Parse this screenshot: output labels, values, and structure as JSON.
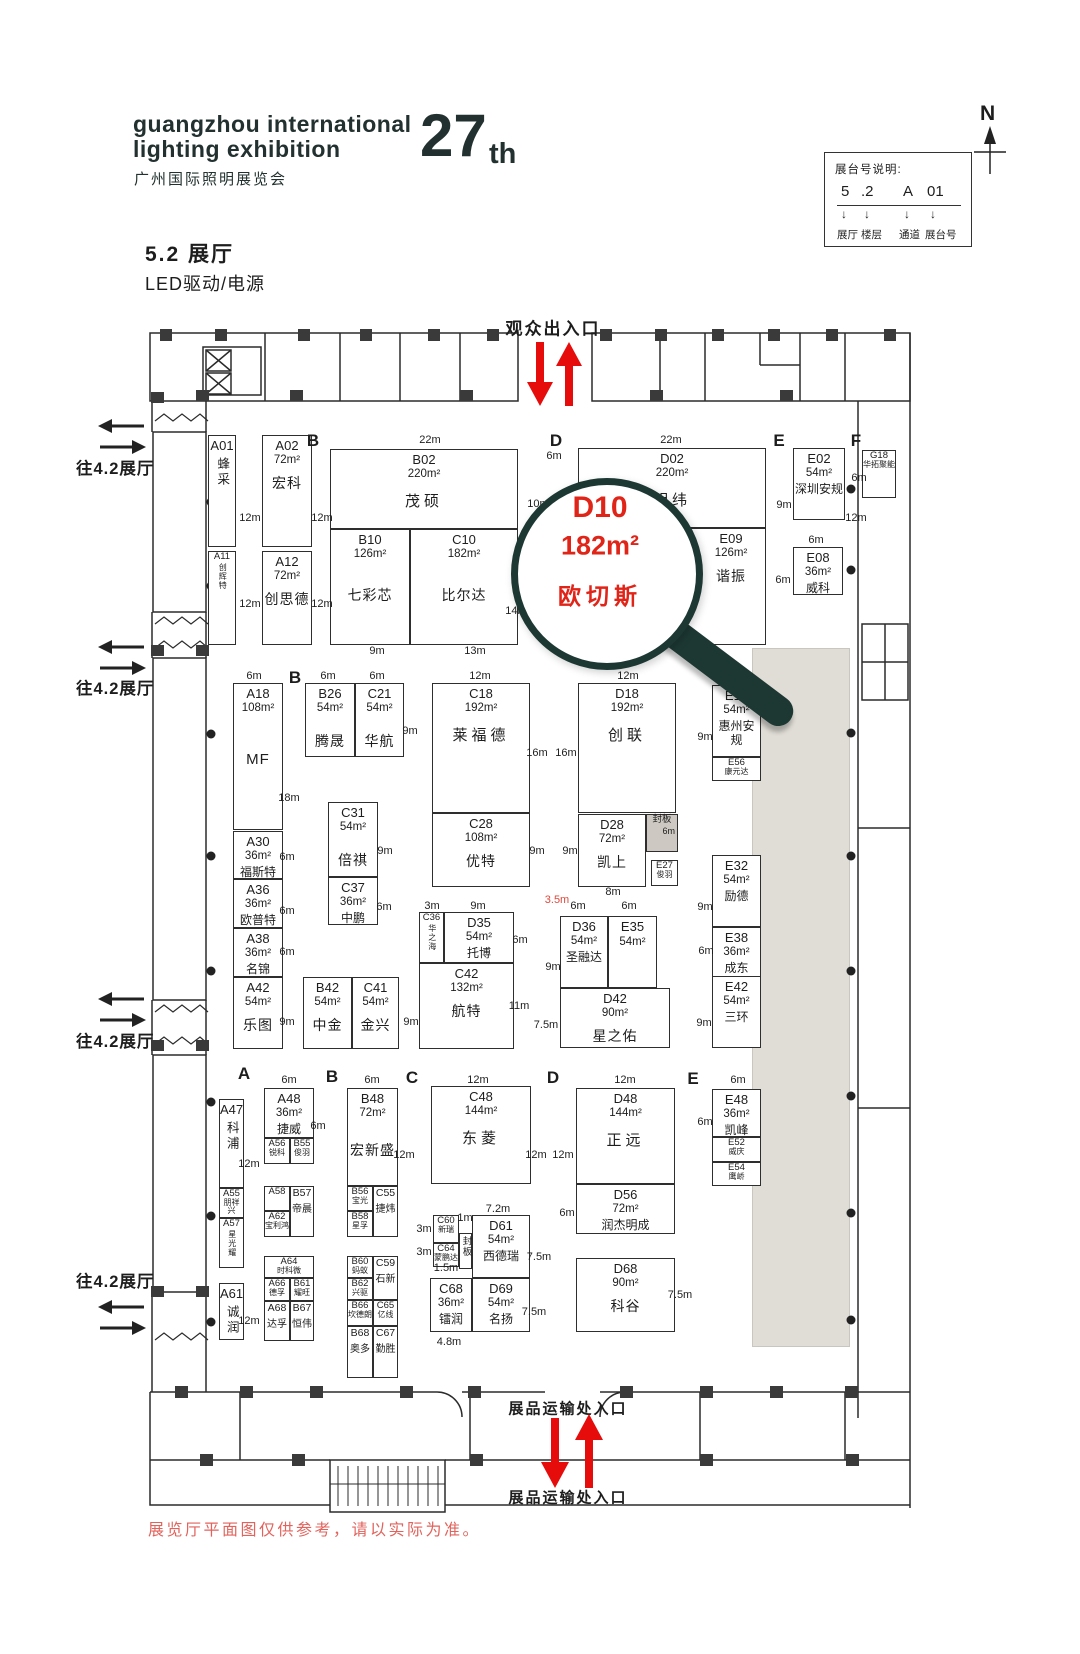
{
  "header": {
    "logo_line1": "guangzhou international",
    "logo_line2": "lighting exhibition",
    "logo_cn": "广州国际照明展览会",
    "edition_number": "27",
    "edition_suffix": "th",
    "hall_title": "5.2 展厅",
    "hall_subtitle": "LED驱动/电源",
    "compass_n": "N"
  },
  "legend": {
    "title": "展台号说明:",
    "code_parts": [
      "5",
      ".2",
      "A",
      "01"
    ],
    "arrow": "↓",
    "labels": [
      "展厅",
      "楼层",
      "通道",
      "展台号"
    ]
  },
  "entrances": {
    "visitor": "观众出入口",
    "freight_top": "展品运输处入口",
    "freight_bottom": "展品运输处入口"
  },
  "side_labels": [
    "往4.2展厅",
    "往4.2展厅",
    "往4.2展厅",
    "往4.2展厅"
  ],
  "letters": [
    "B",
    "D",
    "E",
    "F",
    "B",
    "A",
    "B",
    "C",
    "D",
    "E"
  ],
  "magnifier": {
    "booth_id": "D10",
    "area": "182m²",
    "name": "欧切斯"
  },
  "booths": {
    "A01": {
      "id": "A01",
      "name": "蜂采"
    },
    "A11": {
      "id": "A11",
      "name": "创辉特"
    },
    "A02": {
      "id": "A02",
      "area": "72m²",
      "name": "宏科"
    },
    "A12": {
      "id": "A12",
      "area": "72m²",
      "name": "创思德"
    },
    "B02": {
      "id": "B02",
      "area": "220m²",
      "name": "茂硕"
    },
    "B10": {
      "id": "B10",
      "area": "126m²",
      "name": "七彩芯"
    },
    "C10": {
      "id": "C10",
      "area": "182m²",
      "name": "比尔达"
    },
    "D02": {
      "id": "D02",
      "area": "220m²",
      "name": "明纬"
    },
    "D10": {
      "id": "D10"
    },
    "E09": {
      "id": "E09",
      "area": "126m²",
      "name": "谐振"
    },
    "E02": {
      "id": "E02",
      "area": "54m²",
      "name": "深圳安规"
    },
    "G18": {
      "id": "G18",
      "name": "华拓聚能"
    },
    "E08": {
      "id": "E08",
      "area": "36m²",
      "name": "威科"
    },
    "A18": {
      "id": "A18",
      "area": "108m²",
      "name": "MF"
    },
    "B26": {
      "id": "B26",
      "area": "54m²",
      "name": "腾晟"
    },
    "C21": {
      "id": "C21",
      "area": "54m²",
      "name": "华航"
    },
    "C18": {
      "id": "C18",
      "area": "192m²",
      "name": "莱福德"
    },
    "D18": {
      "id": "D18",
      "area": "192m²",
      "name": "创联"
    },
    "E18": {
      "id": "E18",
      "area": "54m²",
      "name": "惠州安规"
    },
    "E56": {
      "id": "E56",
      "name": "康元达"
    },
    "A30": {
      "id": "A30",
      "area": "36m²",
      "name": "福斯特"
    },
    "C31": {
      "id": "C31",
      "area": "54m²",
      "name": "倍祺"
    },
    "C37": {
      "id": "C37",
      "area": "36m²",
      "name": "中鹏"
    },
    "A36": {
      "id": "A36",
      "area": "36m²",
      "name": "欧普特"
    },
    "A38": {
      "id": "A38",
      "area": "36m²",
      "name": "名锦"
    },
    "C28": {
      "id": "C28",
      "area": "108m²",
      "name": "优特"
    },
    "D28": {
      "id": "D28",
      "area": "72m²",
      "name": "凯上"
    },
    "FB1": {
      "id": "封板",
      "area": "6m"
    },
    "E27": {
      "id": "E27",
      "name": "俊羽"
    },
    "E32": {
      "id": "E32",
      "area": "54m²",
      "name": "励德"
    },
    "E38": {
      "id": "E38",
      "area": "36m²",
      "name": "成东"
    },
    "C36": {
      "id": "C36",
      "name": "华之海"
    },
    "D35": {
      "id": "D35",
      "area": "54m²",
      "name": "托博"
    },
    "C42": {
      "id": "C42",
      "area": "132m²",
      "name": "航特"
    },
    "D36": {
      "id": "D36",
      "area": "54m²",
      "name": "圣融达"
    },
    "E35": {
      "id": "E35",
      "area": "54m²"
    },
    "D42": {
      "id": "D42",
      "area": "90m²",
      "name": "星之佑"
    },
    "E42": {
      "id": "E42",
      "area": "54m²",
      "name": "三环"
    },
    "A42": {
      "id": "A42",
      "area": "54m²",
      "name": "乐图"
    },
    "B42": {
      "id": "B42",
      "area": "54m²",
      "name": "中金"
    },
    "C41": {
      "id": "C41",
      "area": "54m²",
      "name": "金兴"
    },
    "A47": {
      "id": "A47",
      "name": "科浦"
    },
    "A55": {
      "id": "A55",
      "name": "朋祥兴"
    },
    "A57": {
      "id": "A57",
      "name": "星光耀"
    },
    "A61": {
      "id": "A61",
      "name": "诚润"
    },
    "A48": {
      "id": "A48",
      "area": "36m²",
      "name": "捷威"
    },
    "A56": {
      "id": "A56",
      "name": "锐科"
    },
    "B55": {
      "id": "B55",
      "name": "俊羽"
    },
    "A58": {
      "id": "A58"
    },
    "A62": {
      "id": "A62",
      "name": "宝利鸿"
    },
    "B57": {
      "id": "B57",
      "name": "帝晨"
    },
    "B48": {
      "id": "B48",
      "area": "72m²",
      "name": "宏新盛"
    },
    "B56": {
      "id": "B56",
      "name": "宝光"
    },
    "B58": {
      "id": "B58",
      "name": "星孚"
    },
    "C55": {
      "id": "C55",
      "name": "捷炜"
    },
    "C48": {
      "id": "C48",
      "area": "144m²",
      "name": "东菱"
    },
    "D48": {
      "id": "D48",
      "area": "144m²",
      "name": "正远"
    },
    "E48": {
      "id": "E48",
      "area": "36m²",
      "name": "凯峰"
    },
    "E52": {
      "id": "E52",
      "name": "威庆"
    },
    "E54": {
      "id": "E54",
      "name": "鹰峤"
    },
    "D56": {
      "id": "D56",
      "area": "72m²",
      "name": "润杰明成"
    },
    "A64": {
      "id": "A64",
      "name": "时科微"
    },
    "A66": {
      "id": "A66",
      "name": "德孚"
    },
    "B61": {
      "id": "B61",
      "name": "耀旺"
    },
    "A68": {
      "id": "A68",
      "name": "达孚"
    },
    "B67": {
      "id": "B67",
      "name": "恒伟"
    },
    "B60": {
      "id": "B60",
      "name": "蚂蚁"
    },
    "B62": {
      "id": "B62",
      "name": "兴驱"
    },
    "C59": {
      "id": "C59",
      "name": "石新"
    },
    "B66": {
      "id": "B66",
      "name": "坎德朗"
    },
    "C65": {
      "id": "C65",
      "name": "亿线"
    },
    "B68": {
      "id": "B68",
      "name": "奥多"
    },
    "C67": {
      "id": "C67",
      "name": "勤胜"
    },
    "C60": {
      "id": "C60",
      "name": "新瑞"
    },
    "C64": {
      "id": "C64",
      "name": "蒙鹏达"
    },
    "FB2": {
      "id": "封板"
    },
    "D61": {
      "id": "D61",
      "area": "54m²",
      "name": "西德瑞"
    },
    "C68": {
      "id": "C68",
      "area": "36m²",
      "name": "镭润"
    },
    "D69": {
      "id": "D69",
      "area": "54m²",
      "name": "名扬"
    },
    "D68": {
      "id": "D68",
      "area": "90m²",
      "name": "科谷"
    }
  },
  "dims": [
    "12m",
    "12m",
    "12m",
    "12m",
    "22m",
    "22m",
    "6m",
    "10m",
    "9m",
    "13m",
    "14m",
    "9m",
    "12m",
    "6m",
    "6m",
    "6m",
    "6m",
    "18m",
    "6m",
    "6m",
    "9m",
    "12m",
    "16m",
    "16m",
    "12m",
    "9m",
    "6m",
    "9m",
    "6m",
    "6m",
    "9m",
    "9m",
    "8m",
    "9m",
    "6m",
    "3m",
    "9m",
    "6m",
    "6m",
    "6m",
    "9m",
    "6m",
    "11m",
    "9m",
    "9m",
    "7.5m",
    "9m",
    "6m",
    "6m",
    "12m",
    "12m",
    "6m",
    "12m",
    "6m",
    "12m",
    "12m",
    "12m",
    "6m",
    "6m",
    "3m",
    "1m",
    "3m",
    "1.5m",
    "7.2m",
    "7.5m",
    "7.5m",
    "7.5m",
    "4.8m",
    "12m",
    "3.5m"
  ],
  "disclaimer": "展览厅平面图仅供参考，请以实际为准。",
  "colors": {
    "accent_red": "#e60c0c",
    "magnifier_red": "#e02418",
    "wall_dark": "#2b2b2b",
    "gray_zone": "#e0ddd6",
    "panel_gray": "#cdc9c2",
    "disclaimer_red": "#e2635c"
  }
}
